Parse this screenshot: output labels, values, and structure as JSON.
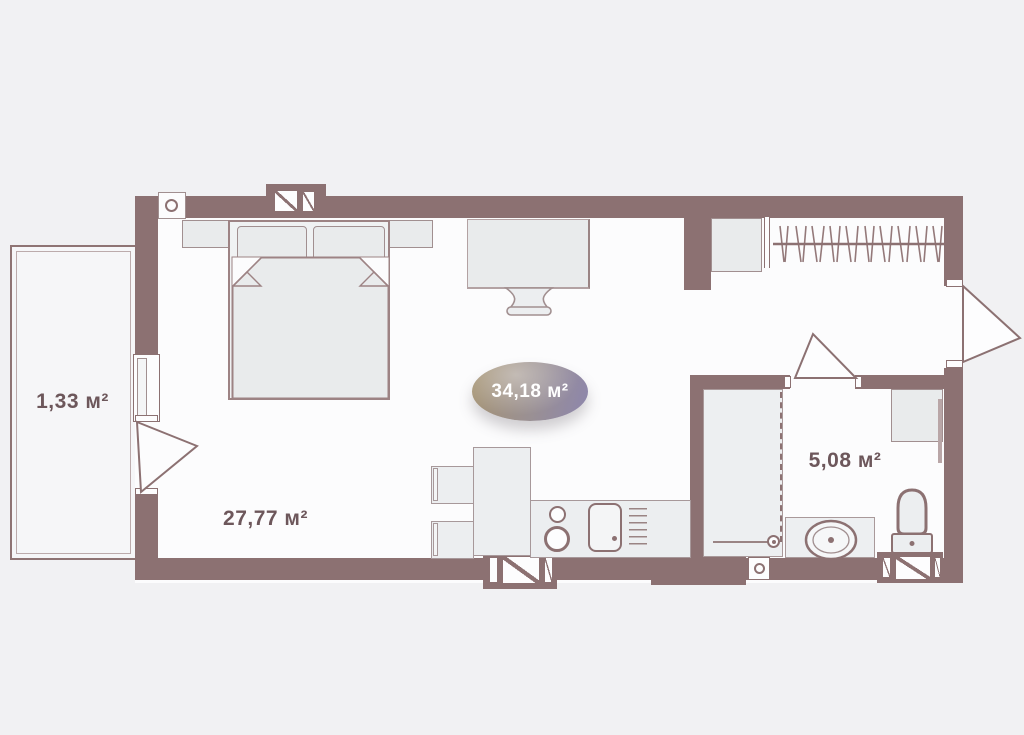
{
  "labels": {
    "balcony_area": "1,33 м²",
    "room_area": "27,77 м²",
    "bathroom_area": "5,08 м²",
    "total_area_badge": "34,18 м²"
  },
  "palette": {
    "wall": "#8c7172",
    "floor": "#fcfcfd",
    "background": "#f1f1f3",
    "furniture_fill": "#eceef0",
    "furniture_border": "#a7989a",
    "label_text": "#6d575b",
    "badge_gradient_left": "#a79573",
    "badge_gradient_mid": "#9a9093",
    "badge_gradient_right": "#8d86ad",
    "badge_text": "#ffffff"
  }
}
